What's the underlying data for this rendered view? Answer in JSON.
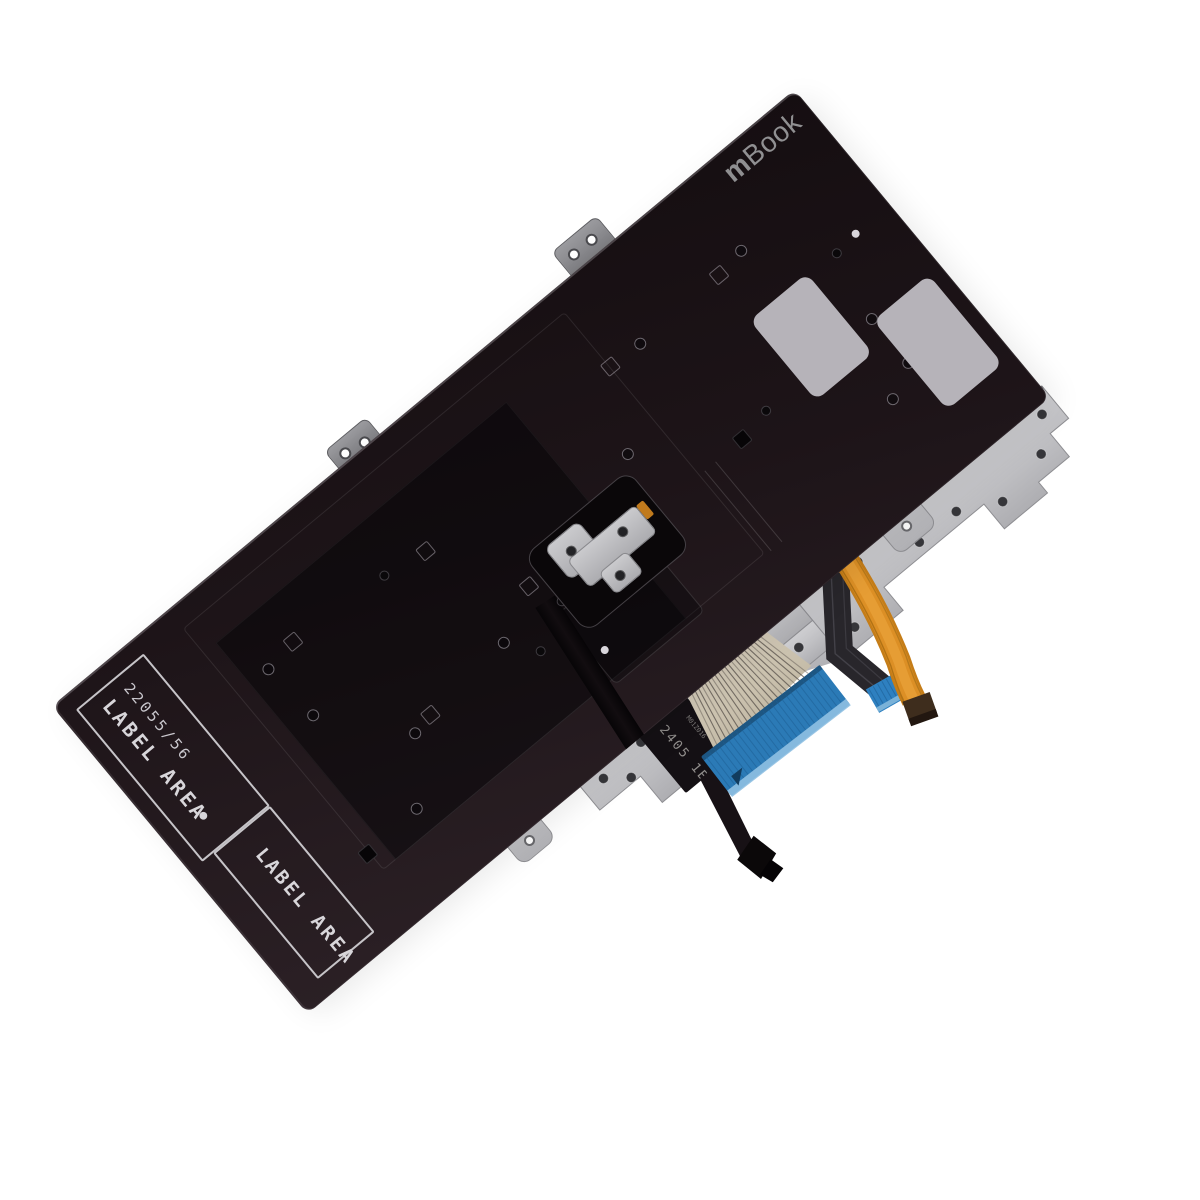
{
  "product": {
    "logo": {
      "bold": "m",
      "light": "Book"
    },
    "label_area": {
      "part_number": "22055/56",
      "label_text": "LABEL AREA",
      "dot": "●",
      "label_text_2": "LABEL AREA"
    },
    "cable_markings": {
      "date_code": "2405 1B",
      "small_code": "M01Z016"
    }
  },
  "colors": {
    "background": "#ffffff",
    "panel_dark": "#1d1418",
    "panel_light_edge": "#2b2025",
    "sticker_gray": "#b6b3b9",
    "metal_silver": "#c3c3c6",
    "ribbon_beige": "#cfc6b2",
    "connector_blue": "#2b7ab6",
    "cable_orange": "#d88d26",
    "label_outline": "#c6c4c8"
  },
  "features": {
    "rings": [
      [
        190,
        110
      ],
      [
        195,
        174
      ],
      [
        262,
        253
      ],
      [
        215,
        312
      ],
      [
        388,
        240
      ],
      [
        684,
        97
      ],
      [
        604,
        174
      ],
      [
        821,
        90
      ],
      [
        878,
        226
      ],
      [
        878,
        283
      ],
      [
        843,
        301
      ]
    ],
    "dots": [
      [
        339,
        112
      ],
      [
        411,
        270
      ],
      [
        459,
        245
      ],
      [
        738,
        229
      ],
      [
        893,
        153
      ]
    ],
    "squares": [
      [
        226,
        104
      ],
      [
        386,
        119
      ],
      [
        646,
        95
      ],
      [
        788,
        94
      ],
      [
        443,
        212
      ],
      [
        285,
        248
      ]
    ],
    "dark_squares": [
      [
        148,
        315
      ],
      [
        701,
        235
      ]
    ],
    "light_dots": [
      [
        920,
        150
      ],
      [
        461,
        310
      ]
    ],
    "plate_holes": [
      [
        378,
        408
      ],
      [
        400,
        425
      ],
      [
        430,
        404
      ],
      [
        452,
        428
      ],
      [
        500,
        398
      ],
      [
        612,
        432
      ],
      [
        676,
        398
      ],
      [
        700,
        430
      ],
      [
        668,
        452
      ],
      [
        712,
        404
      ],
      [
        772,
        428
      ],
      [
        820,
        428
      ],
      [
        862,
        450
      ],
      [
        922,
        438
      ],
      [
        948,
        408
      ]
    ],
    "trace_count": 22,
    "connector_stripe_count": 26,
    "narrow_stripe_count": 7
  }
}
